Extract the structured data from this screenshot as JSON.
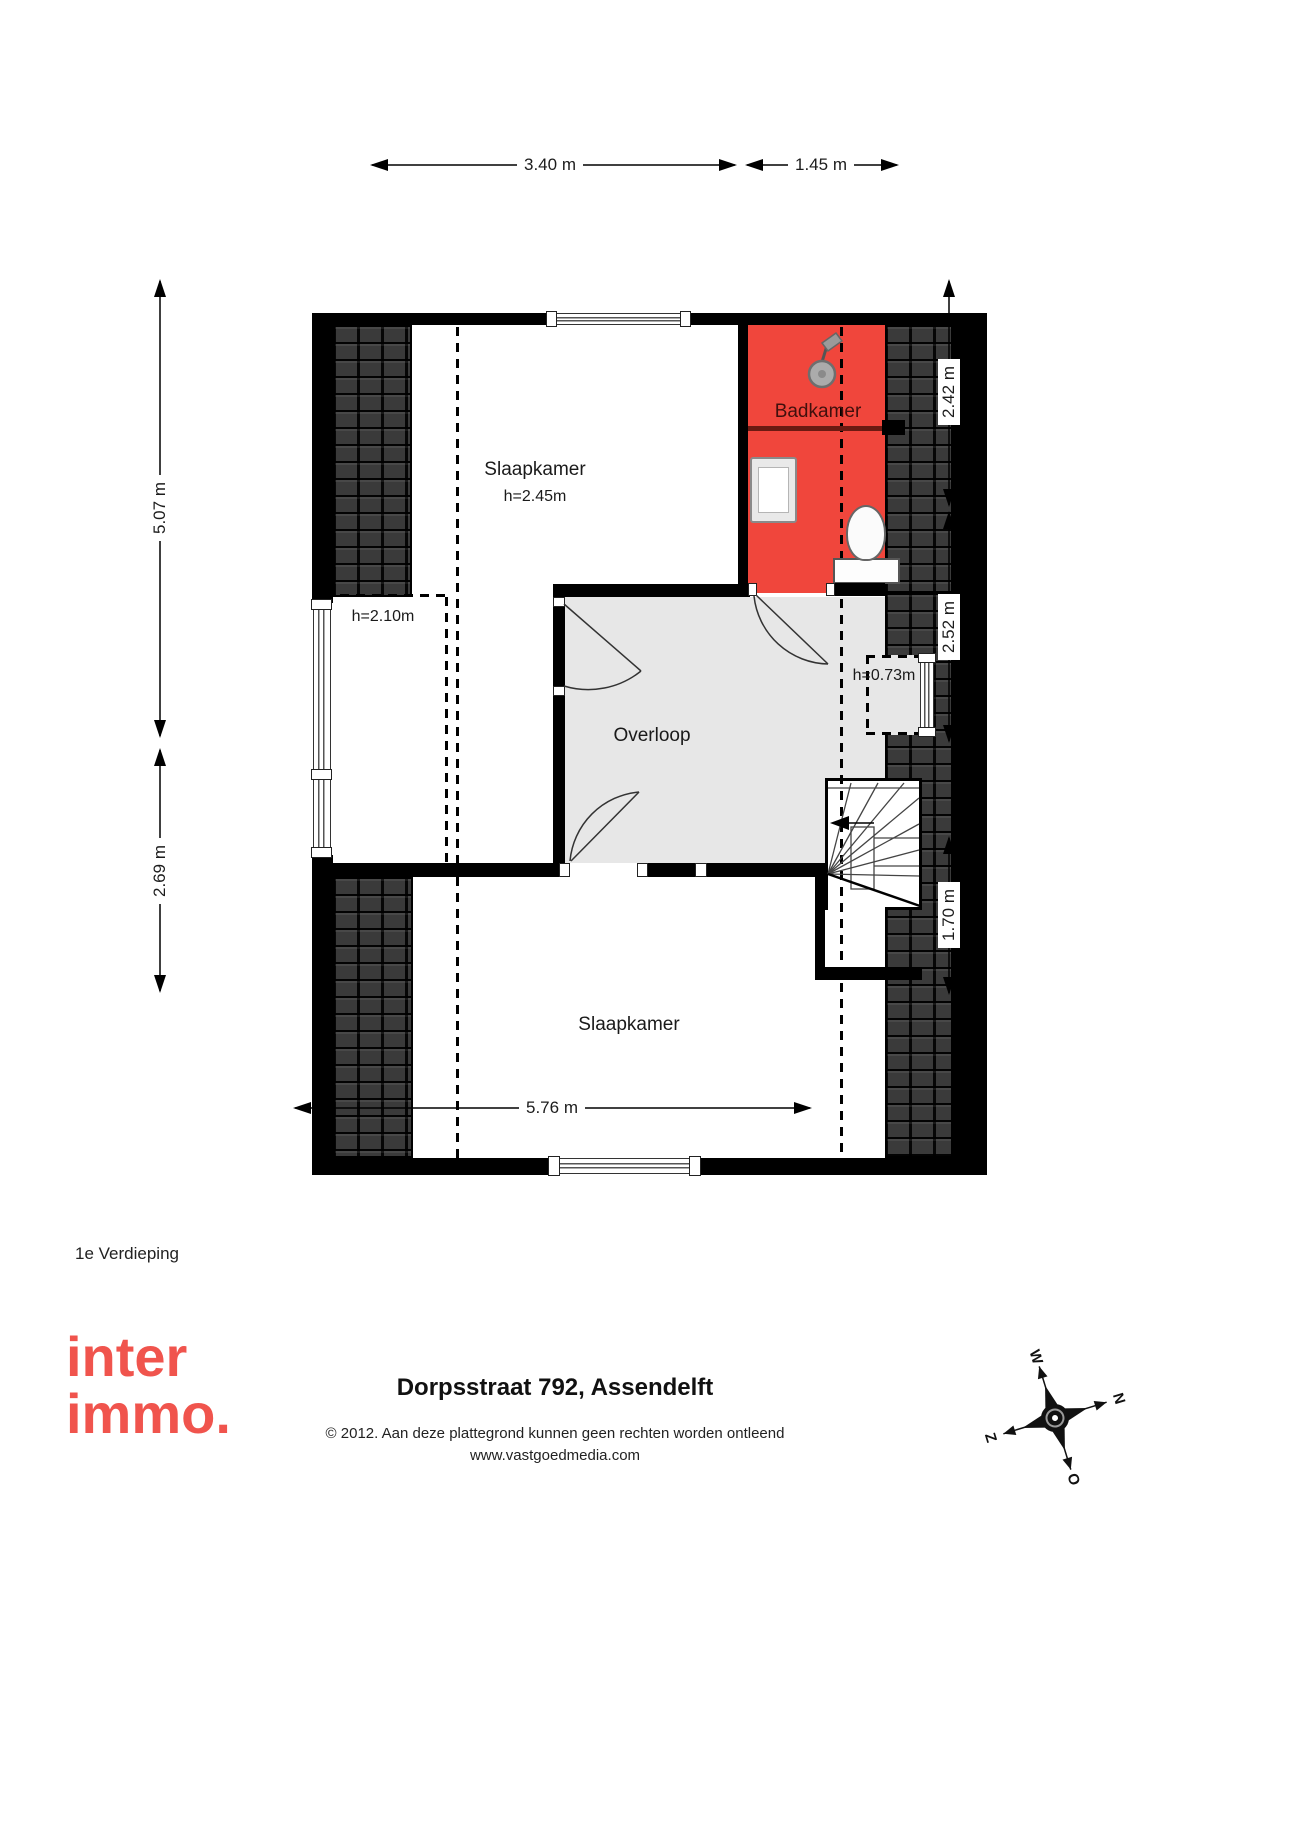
{
  "plan": {
    "floor_label": "1e Verdieping",
    "rooms": {
      "bedroom_top": {
        "name": "Slaapkamer",
        "height": "h=2.45m"
      },
      "bathroom": {
        "name": "Badkamer"
      },
      "landing": {
        "name": "Overloop"
      },
      "bedroom_bottom": {
        "name": "Slaapkamer"
      },
      "knee_height_left": "h=2.10m",
      "knee_height_right": "h=0.73m"
    },
    "dimensions": {
      "top_a": "3.40 m",
      "top_b": "1.45 m",
      "left_a": "5.07 m",
      "left_b": "2.69 m",
      "right_a": "2.42 m",
      "right_b": "2.52 m",
      "right_c": "1.70 m",
      "bottom": "5.76 m"
    },
    "colors": {
      "bathroom": "#f0463c",
      "landing": "#e7e7e7",
      "accent": "#f0544d"
    }
  },
  "footer": {
    "logo_line1": "inter",
    "logo_line2": "immo.",
    "address": "Dorpsstraat 792, Assendelft",
    "copyright": "© 2012. Aan deze plattegrond kunnen geen rechten worden ontleend",
    "website": "www.vastgoedmedia.com",
    "compass": {
      "n": "N",
      "e": "O",
      "s": "Z",
      "w": "W"
    }
  }
}
